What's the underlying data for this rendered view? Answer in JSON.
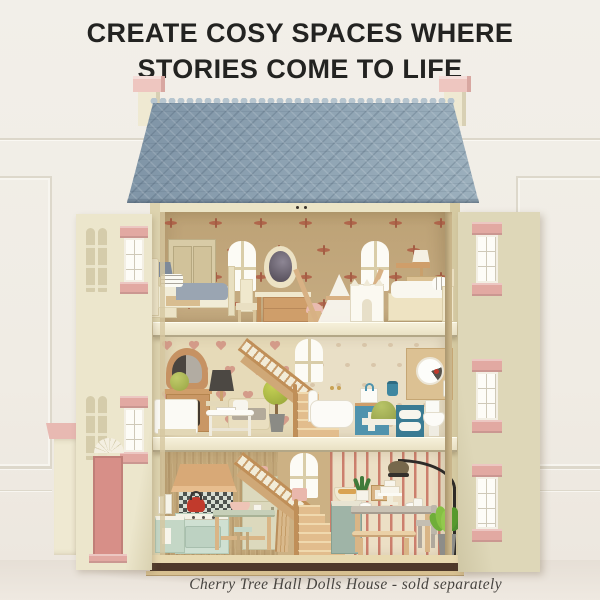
{
  "page": {
    "type": "product hero image"
  },
  "headline": {
    "line1": "CREATE COSY SPACES WHERE",
    "line2": "STORIES COME TO LIFE",
    "color": "#232321"
  },
  "caption": {
    "text": "Cherry Tree Hall Dolls House - sold separately",
    "color": "#474440"
  },
  "product": {
    "name": "Cherry Tree Hall Dolls House",
    "availability_note": "sold separately"
  },
  "palette": {
    "background_cream": "#f1eee7",
    "roof_blue": "#8da2b2",
    "ridge_blue": "#b6c5cf",
    "house_cream": "#e9e2c6",
    "door_cream": "#ece6cc",
    "shutter_pink": "#e2a9a2",
    "front_door_pink": "#d78f88",
    "chimney_pink": "#eec6c0",
    "wallpaper_tan": "#c6ac82",
    "dragonfly_red": "#ad5640",
    "hearts_cream": "#e6dab8",
    "heart_pink": "#d08d7f",
    "stripe_pink": "#cc7f6d",
    "wood_tan": "#cf9e6a",
    "blanket_grey": "#9aa5b2",
    "mint_green": "#cfe0d2",
    "teal_blue": "#4f93ad",
    "apple_green": "#b5c244",
    "leaf_green": "#86c043",
    "kettle_red": "#c13a2c",
    "lamp_charcoal": "#4c4843"
  }
}
